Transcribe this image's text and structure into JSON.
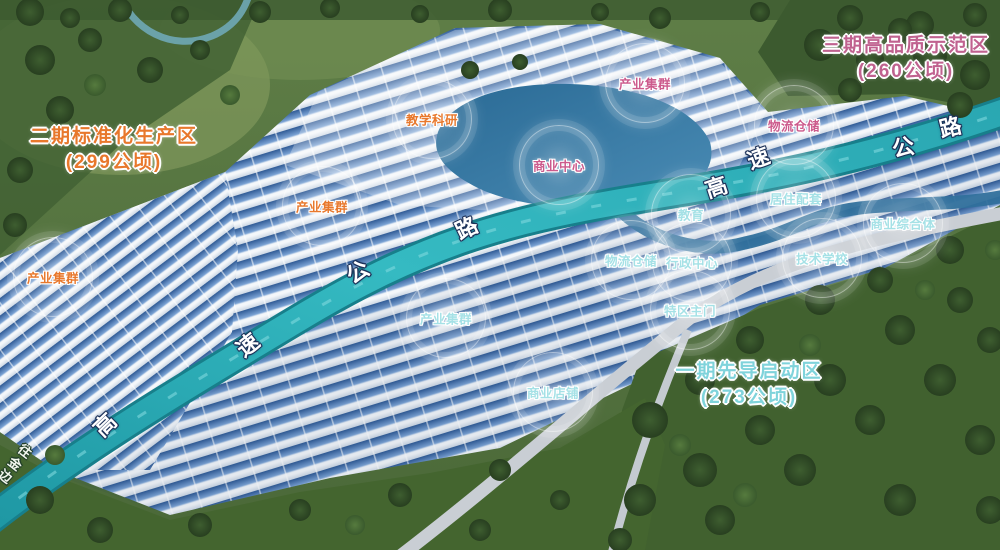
{
  "zones": [
    {
      "id": "phase-2",
      "line1": "二期标准化生产区",
      "line2": "(299公顷)",
      "color": "#e8782c",
      "x": 114,
      "y": 150
    },
    {
      "id": "phase-3",
      "line1": "三期高品质示范区",
      "line2": "(260公顷)",
      "color": "#c0628f",
      "x": 906,
      "y": 59
    },
    {
      "id": "phase-1",
      "line1": "一期先导启动区",
      "line2": "(273公顷)",
      "color": "#7fd3db",
      "x": 749,
      "y": 385
    }
  ],
  "label_colors": {
    "pink": "#cc5a8c",
    "orange": "#e8782c",
    "cyan": "#a5e1e6"
  },
  "facilities": [
    {
      "label": "产业集群",
      "color": "pink",
      "x": 645,
      "y": 83
    },
    {
      "label": "教学科研",
      "color": "orange",
      "x": 432,
      "y": 119
    },
    {
      "label": "商业中心",
      "color": "pink",
      "x": 559,
      "y": 165
    },
    {
      "label": "物流仓储",
      "color": "pink",
      "x": 794,
      "y": 125
    },
    {
      "label": "产业集群",
      "color": "orange",
      "x": 322,
      "y": 206
    },
    {
      "label": "居住配套",
      "color": "cyan",
      "x": 796,
      "y": 198
    },
    {
      "label": "教育",
      "color": "cyan",
      "x": 691,
      "y": 214
    },
    {
      "label": "商业综合体",
      "color": "cyan",
      "x": 903,
      "y": 223
    },
    {
      "label": "物流仓储",
      "color": "cyan",
      "x": 631,
      "y": 260
    },
    {
      "label": "行政中心",
      "color": "cyan",
      "x": 692,
      "y": 262
    },
    {
      "label": "技术学校",
      "color": "cyan",
      "x": 822,
      "y": 258
    },
    {
      "label": "产业集群",
      "color": "orange",
      "x": 53,
      "y": 277
    },
    {
      "label": "产业集群",
      "color": "cyan",
      "x": 446,
      "y": 318
    },
    {
      "label": "特区主门",
      "color": "cyan",
      "x": 690,
      "y": 310
    },
    {
      "label": "商业店铺",
      "color": "cyan",
      "x": 553,
      "y": 392
    }
  ],
  "road_labels": [
    {
      "char": "高",
      "x": 104,
      "y": 424,
      "rot": -44
    },
    {
      "char": "速",
      "x": 247,
      "y": 344,
      "rot": -38
    },
    {
      "char": "公",
      "x": 357,
      "y": 271,
      "rot": -33
    },
    {
      "char": "路",
      "x": 466,
      "y": 227,
      "rot": -26
    },
    {
      "char": "高",
      "x": 716,
      "y": 186,
      "rot": -18
    },
    {
      "char": "速",
      "x": 758,
      "y": 157,
      "rot": -20
    },
    {
      "char": "公",
      "x": 903,
      "y": 146,
      "rot": -12
    },
    {
      "char": "路",
      "x": 950,
      "y": 126,
      "rot": -14
    }
  ],
  "corner_label": {
    "text": "往金边",
    "x": 4,
    "y": 440,
    "rot": 38
  },
  "scene_colors": {
    "vegetation": "#4d6b3a",
    "forest": "#3a5a2d",
    "building_roof": "#5b87c5",
    "building_wall": "#eef3f8",
    "highway": "#2fb3bc",
    "water": "#2f6f9c",
    "road": "#c9ced4"
  }
}
